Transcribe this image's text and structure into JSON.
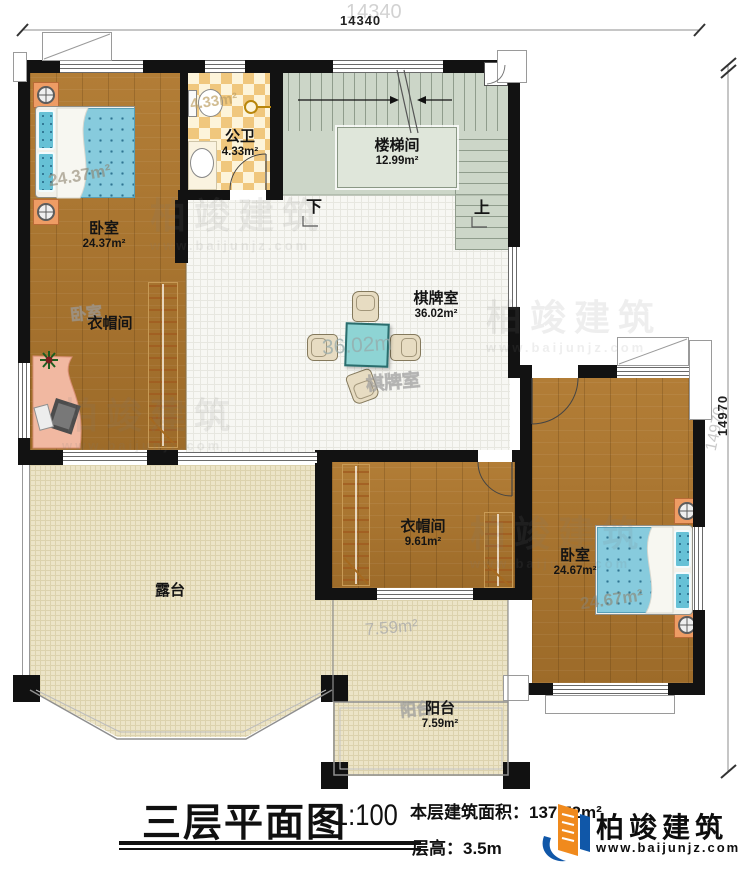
{
  "dimensions": {
    "top": "14340",
    "right": "14970"
  },
  "rooms": {
    "bedroom_left": {
      "name": "卧室",
      "area": "24.37m²"
    },
    "bathroom": {
      "name": "公卫",
      "area": "4.33m²"
    },
    "stairwell": {
      "name": "楼梯间",
      "area": "12.99m²"
    },
    "chess_room": {
      "name": "棋牌室",
      "area": "36.02m²"
    },
    "cloakroom_left": {
      "name": "衣帽间"
    },
    "cloakroom_bottom": {
      "name": "衣帽间",
      "area": "9.61m²"
    },
    "bedroom_right": {
      "name": "卧室",
      "area": "24.67m²"
    },
    "terrace": {
      "name": "露台"
    },
    "balcony": {
      "name": "阳台",
      "area": "7.59m²"
    }
  },
  "stairs": {
    "down": "下",
    "up": "上"
  },
  "ghost_labels": {
    "dim_top": "14340",
    "dim_right": "14970",
    "bedroom_left_area": "24.37m²",
    "bedroom_left_name": "卧室",
    "bathroom_area": "4.33m²",
    "chess_area": "36.02m",
    "chess_name": "棋牌室",
    "bedroom_right_area": "24.67m²",
    "balcony_area": "7.59m²",
    "balcony_name": "阳台"
  },
  "title_block": {
    "title": "三层平面图",
    "scale": "1:100",
    "area_label": "本层建筑面积：",
    "area_value": "137.72m²",
    "height_label": "层高：",
    "height_value": "3.5m"
  },
  "brand": {
    "name": "柏竣建筑",
    "url": "www.baijunjz.com"
  },
  "watermark": {
    "name": "柏竣建筑",
    "url": "www.baijunjz.com"
  },
  "colors": {
    "wall": "#121212",
    "wood": "#ab752e",
    "bed": "#87cbdd",
    "tile_light": "#fdf4da",
    "tile_orange": "#f0c77d",
    "stair": "#ccd6c8",
    "terrace": "#ece4c7",
    "table": "#8ed4d4",
    "brand_blue": "#1057a8",
    "brand_orange": "#f08a1d"
  }
}
